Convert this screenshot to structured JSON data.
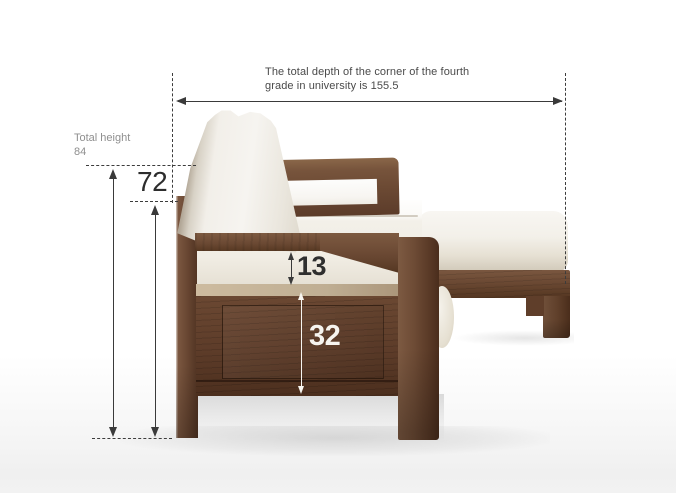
{
  "figure": {
    "description": "Side-view dimension diagram of a walnut wood sofa with storage base and chaise ottoman, cream cushions"
  },
  "annotations": {
    "total_depth": {
      "text_line1": "The total depth of the corner of the fourth",
      "text_line2": "grade in university is 155.5",
      "value": "155.5"
    },
    "total_height": {
      "label": "Total height",
      "value": "84"
    },
    "backrest_height": {
      "value": "72"
    },
    "cushion_thickness": {
      "value": "13"
    },
    "base_height": {
      "value": "32"
    }
  },
  "colors": {
    "dimension_line": "#3a3a3a",
    "muted_label": "#8f8f8f",
    "annotation_white": "#f6f4ef",
    "wood_mid": "#6b4a33",
    "cushion_white": "#f3f1ec",
    "background": "#ffffff"
  }
}
